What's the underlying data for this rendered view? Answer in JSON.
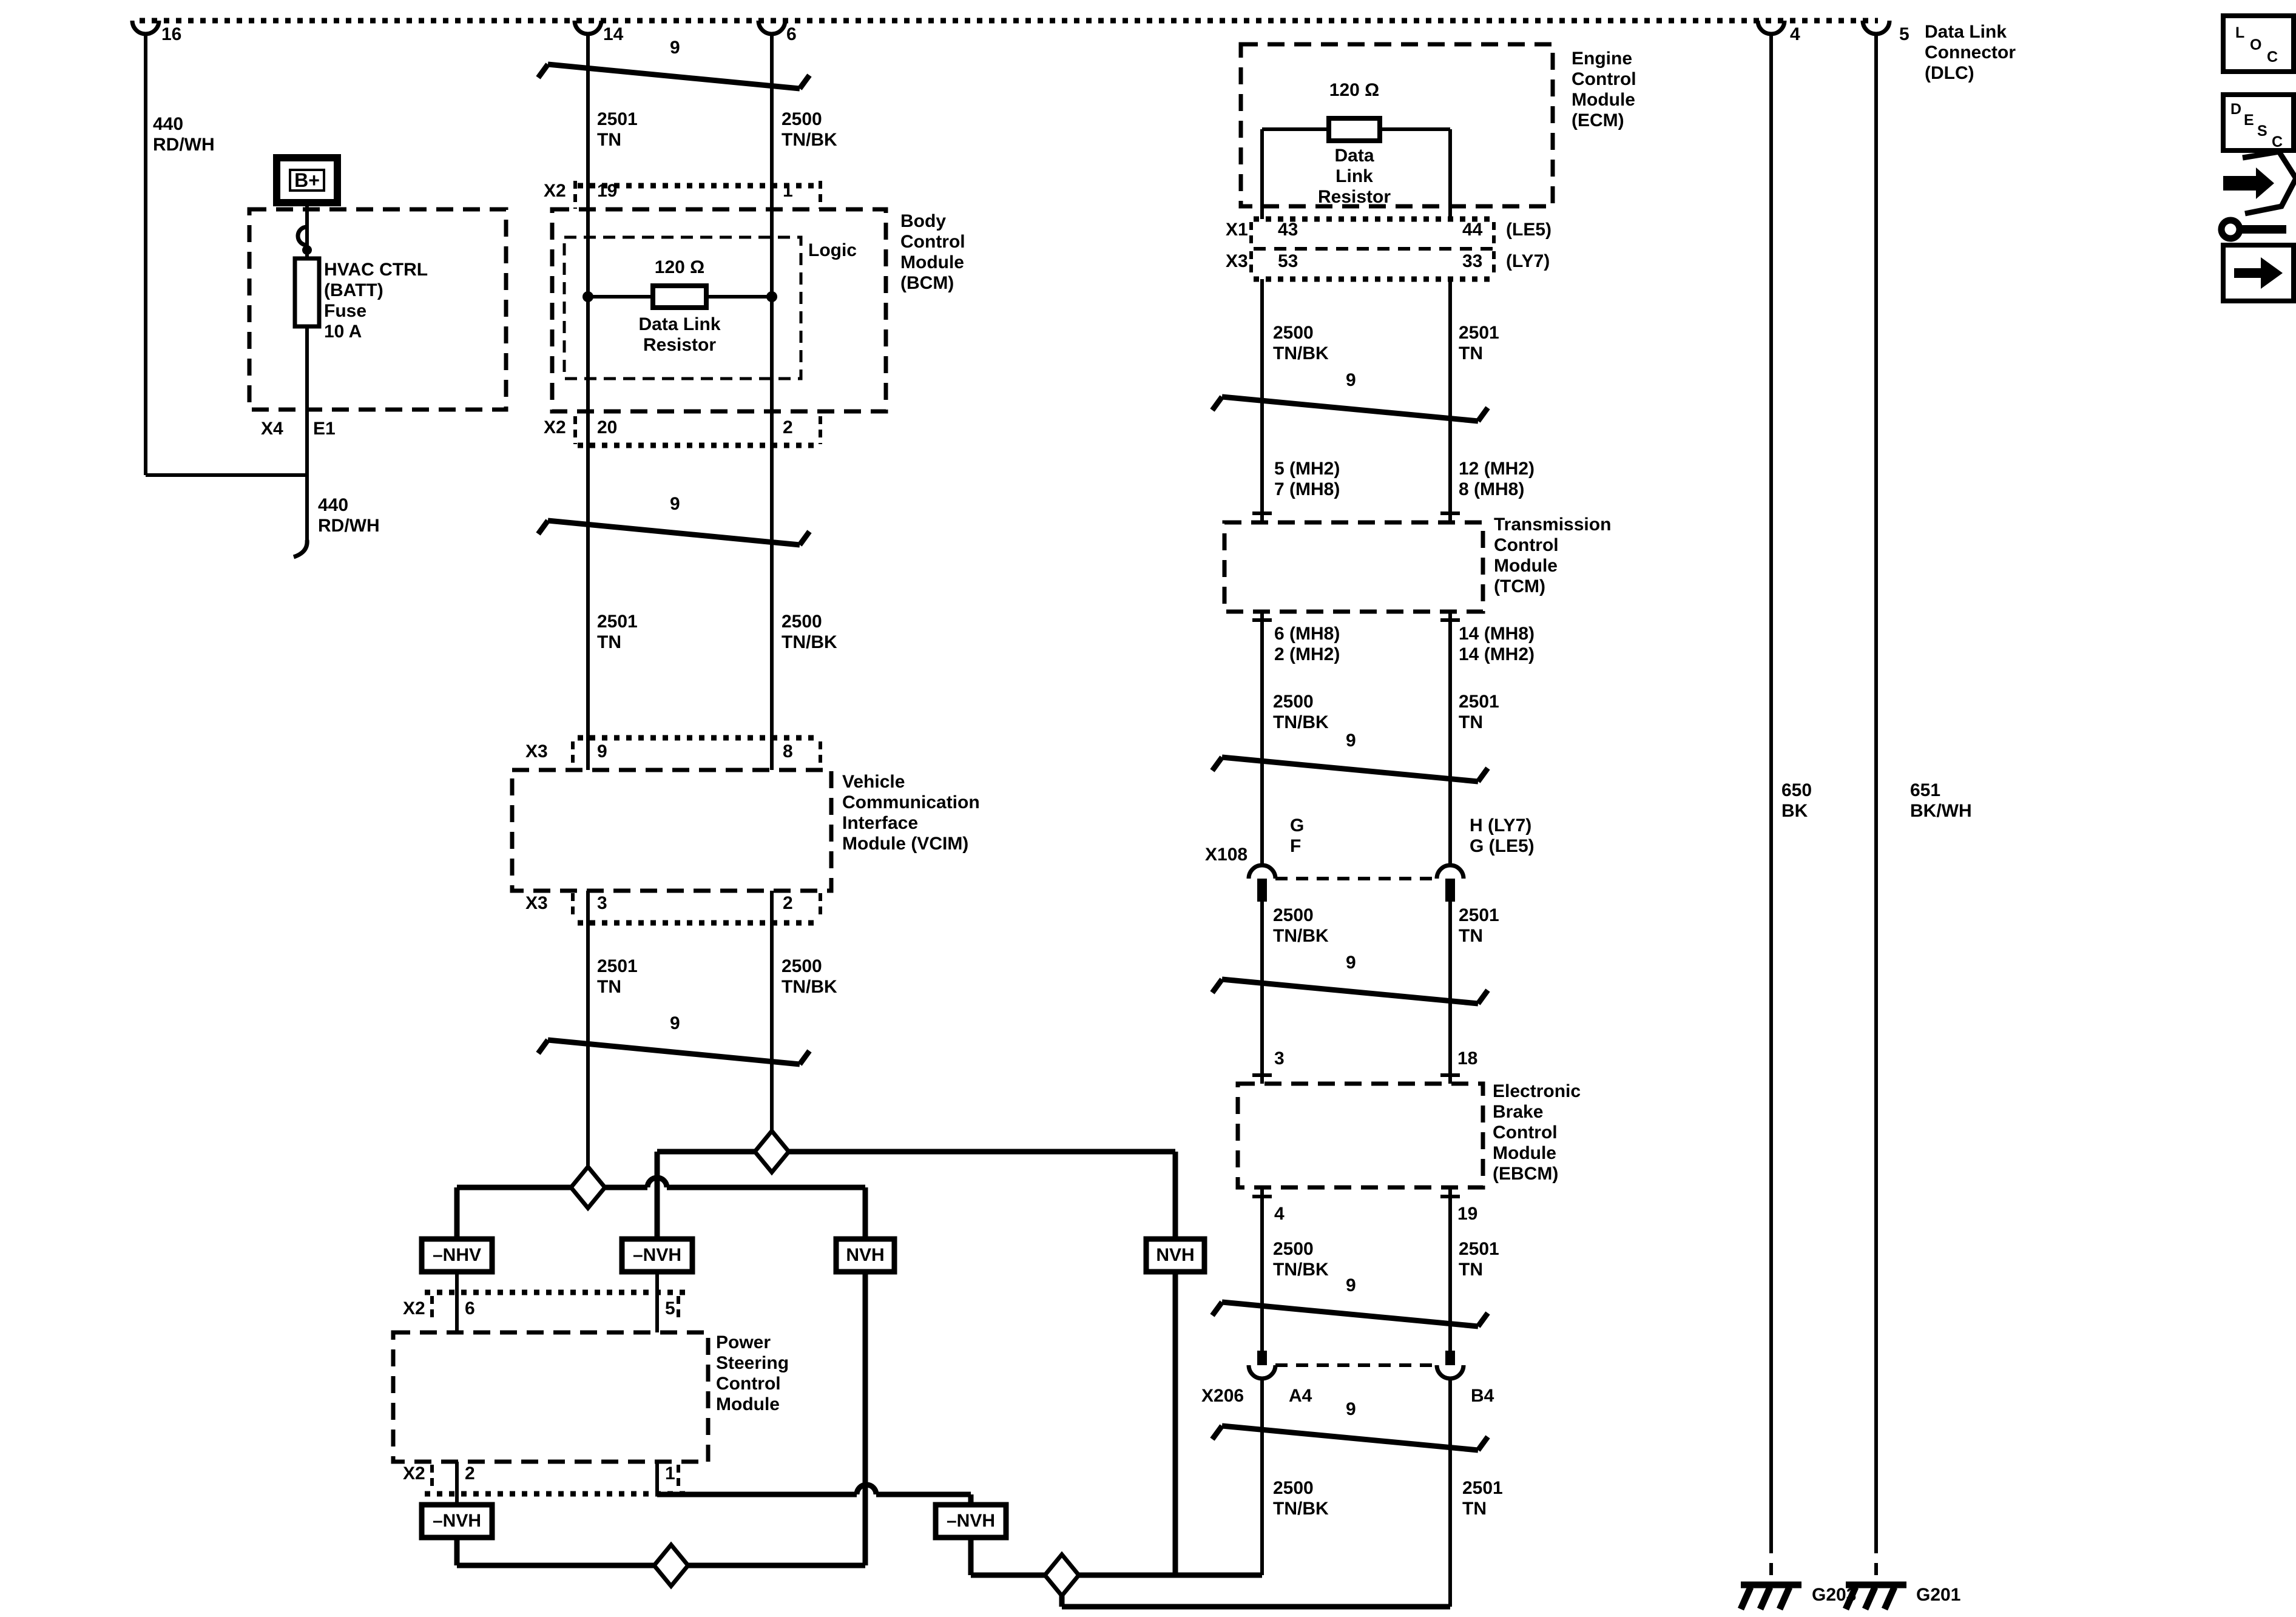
{
  "dlc": {
    "pin16": "16",
    "pin14": "14",
    "pin6": "6",
    "pin4": "4",
    "pin5": "5",
    "name": "Data Link\nConnector\n(DLC)"
  },
  "left": {
    "wire440_top": "440\nRD/WH",
    "bplus": "B+",
    "fuse": "HVAC CTRL\n(BATT)\nFuse\n10 A",
    "x4": "X4",
    "e1": "E1",
    "wire440_bot": "440\nRD/WH"
  },
  "bcm": {
    "x2": "X2",
    "pin19": "19",
    "pin1": "1",
    "pin20": "20",
    "pin2": "2",
    "logic": "Logic",
    "ohms": "120 Ω",
    "resistor": "Data Link\nResistor",
    "name": "Body\nControl\nModule\n(BCM)"
  },
  "vcim": {
    "x3": "X3",
    "pin9": "9",
    "pin8": "8",
    "pin3": "3",
    "pin2": "2",
    "name": "Vehicle\nCommunication\nInterface\nModule (VCIM)"
  },
  "pscm": {
    "x2": "X2",
    "pin6": "6",
    "pin5": "5",
    "pin2": "2",
    "pin1": "1",
    "name": "Power\nSteering\nControl\nModule"
  },
  "ecm": {
    "ohms": "120 Ω",
    "resistor": "Data\nLink\nResistor",
    "name": "Engine\nControl\nModule\n(ECM)",
    "x1": "X1",
    "pin43": "43",
    "pin44": "44",
    "le5": "(LE5)",
    "x3": "X3",
    "pin53": "53",
    "pin33": "33",
    "ly7": "(LY7)"
  },
  "tcm": {
    "pins_ul": "5 (MH2)\n7 (MH8)",
    "pins_ur": "12 (MH2)\n8 (MH8)",
    "pins_ll": "6 (MH8)\n2 (MH2)",
    "pins_lr": "14 (MH8)\n14 (MH2)",
    "name": "Transmission\nControl\nModule\n(TCM)"
  },
  "ebcm": {
    "pin3": "3",
    "pin18": "18",
    "pin4": "4",
    "pin19": "19",
    "name": "Electronic\nBrake\nControl\nModule\n(EBCM)"
  },
  "x108": {
    "label": "X108",
    "left_pins": "G\nF",
    "right_pins": "H (LY7)\nG (LE5)"
  },
  "x206": {
    "label": "X206",
    "a4": "A4",
    "b4": "B4"
  },
  "wires": {
    "w2501": "2501\nTN",
    "w2500": "2500\nTN/BK",
    "w650": "650\nBK",
    "w651": "651\nBK/WH",
    "twist": "9"
  },
  "terminations": {
    "nhv": "–NHV",
    "nvh_minus": "–NVH",
    "nvh": "NVH"
  },
  "grounds": {
    "g203": "G203",
    "g201": "G201"
  },
  "icons": {
    "loc": [
      "L",
      "O",
      "C"
    ],
    "desc": [
      "D",
      "E",
      "S",
      "C"
    ]
  }
}
